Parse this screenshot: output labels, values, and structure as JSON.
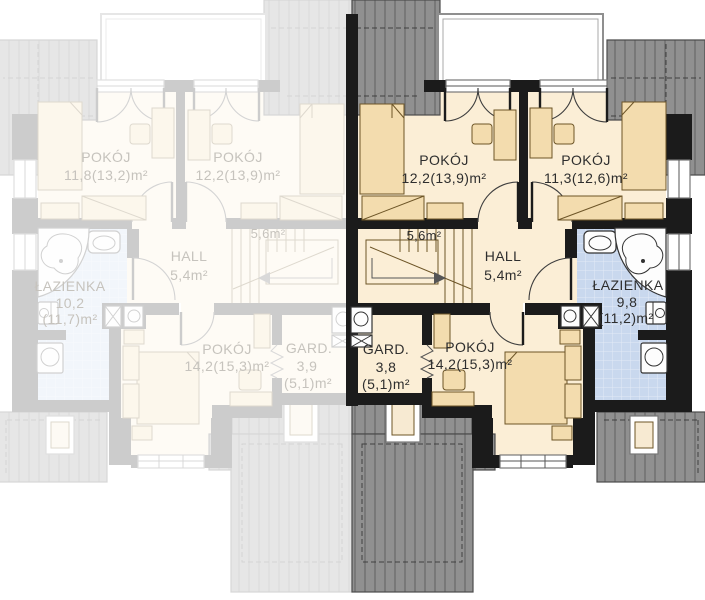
{
  "plan": {
    "type": "floor-plan",
    "right_unit": {
      "state": "active",
      "rooms": {
        "pokoj1": {
          "name": "POKÓJ",
          "area": "12,2(13,9)m²"
        },
        "pokoj2": {
          "name": "POKÓJ",
          "area": "11,3(12,6)m²"
        },
        "stairs": {
          "area": "5,6m²"
        },
        "hall": {
          "name": "HALL",
          "area": "5,4m²"
        },
        "lazienka": {
          "name": "ŁAZIENKA",
          "area": "9,8",
          "area_total": "(11,2)m²"
        },
        "gard": {
          "name": "GARD.",
          "area": "3,8",
          "area_total": "(5,1)m²"
        },
        "pokoj3": {
          "name": "POKÓJ",
          "area": "14,2(15,3)m²"
        }
      }
    },
    "left_unit": {
      "state": "faded-mirror",
      "rooms": {
        "pokoj1": {
          "name": "POKÓJ",
          "area": "11,8(13,2)m²"
        },
        "pokoj2": {
          "name": "POKÓJ",
          "area": "12,2(13,9)m²"
        },
        "stairs": {
          "area": "5,6m²"
        },
        "hall": {
          "name": "HALL",
          "area": "5,4m²"
        },
        "lazienka": {
          "name": "ŁAZIENKA",
          "area": "10,2",
          "area_total": "(11,7)m²"
        },
        "pokoj3": {
          "name": "POKÓJ",
          "area": "14,2(15,3)m²"
        },
        "gard": {
          "name": "GARD.",
          "area": "3,9",
          "area_total": "(5,1)m²"
        }
      }
    },
    "colors": {
      "wall": "#1b1b1b",
      "floor": "#fbeed6",
      "furniture": "#f3dcae",
      "bathroom_tile": "#c9d8ee",
      "roof": "#909090",
      "balcony": "#ffffff",
      "label": "#2e2e2e",
      "faded_label": "#c6c3bd"
    }
  }
}
